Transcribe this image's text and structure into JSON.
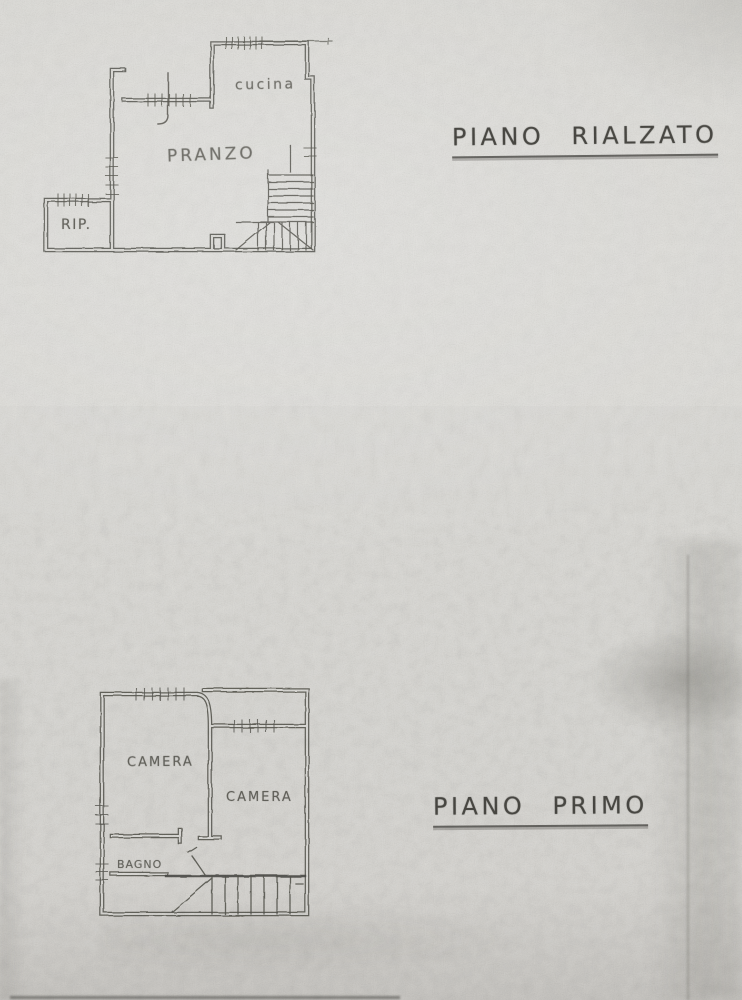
{
  "paper": {
    "background": "#e2e1dd",
    "ink": "#54534e"
  },
  "floors": {
    "rialzato": {
      "title": "PIANO RIALZATO",
      "rooms": {
        "cucina": "cucina",
        "pranzo": "PRANZO",
        "rip": "RIP."
      }
    },
    "primo": {
      "title": "PIANO PRIMO",
      "rooms": {
        "camera_left": "CAMERA",
        "camera_right": "CAMERA",
        "bagno": "BAGNO"
      }
    }
  }
}
